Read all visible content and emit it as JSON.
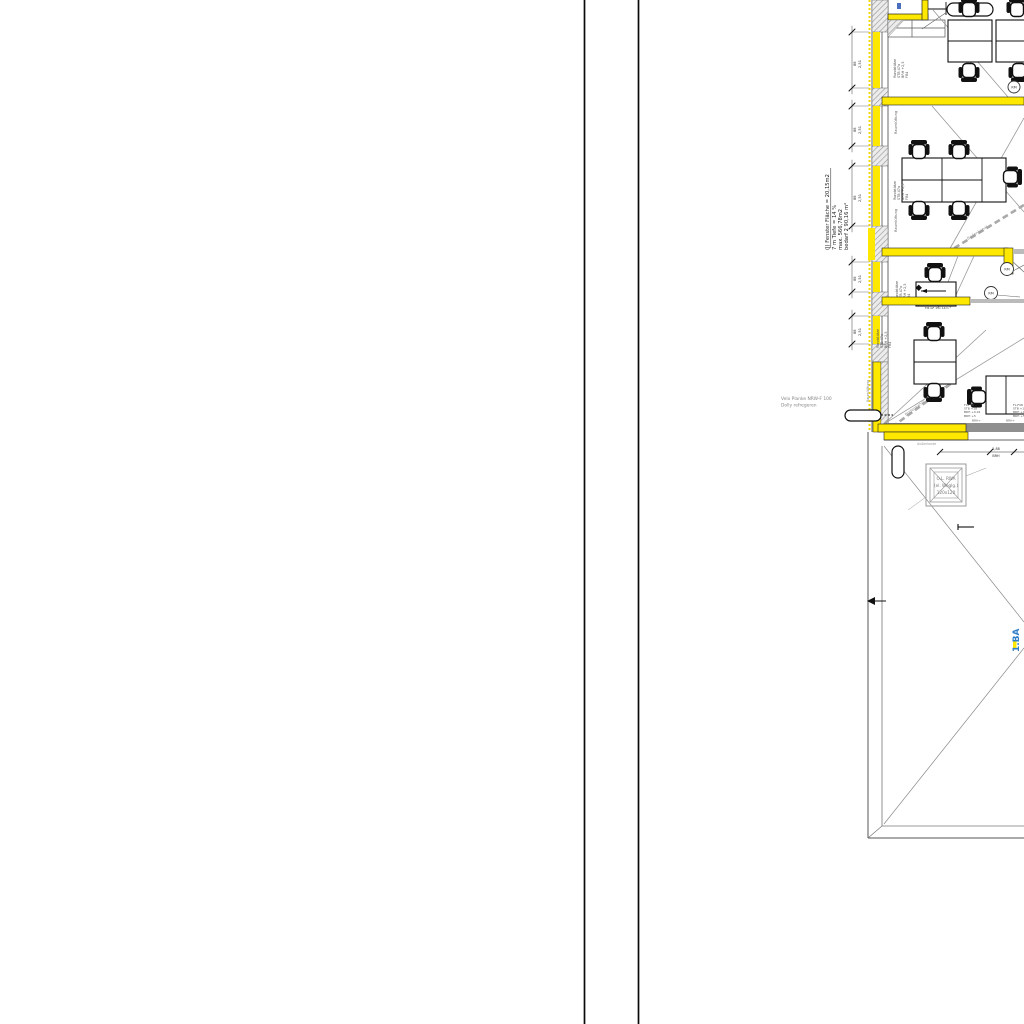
{
  "document": {
    "kind": "architectural-floor-plan-fragment",
    "background": "#ffffff"
  },
  "colors": {
    "divider_line": "#0a0a0a",
    "wall_yellow": "#ffe800",
    "wall_gray": "#8f8f8f",
    "hatch_gray": "#9a9a9a",
    "annotation_gray": "#555555",
    "accent_blue": "#2e7fc8"
  },
  "texts": {
    "fenster_note": {
      "l1": "(J) Fenster Fläche = 20,15m2",
      "l2": "7 m Tiefe = 14 %",
      "l3": "max. 566,78m2",
      "l4": "bedarf 2 90,16 m²"
    },
    "window_label": "Raumlüftung",
    "win_block": {
      "l1": "Rundstütze",
      "l2": "STB 47a",
      "l3": "BRH +2,5",
      "l4": "F84"
    },
    "desk_block": {
      "l1": "FL-F08",
      "l2": "STB +18",
      "l3": "BRH +0,91",
      "l4": "BRH +5"
    },
    "note_left": {
      "l1": "Velo Planke NRW-F 100",
      "l2": "Dolly refregeren"
    },
    "rwa": {
      "l1": "O.L. RWA",
      "l2": "(el. Weglg.)",
      "l3": "120x120"
    },
    "dim": {
      "a": "88",
      "b": "2,51"
    },
    "dim_hall": {
      "a": "5,88",
      "b": "BRH"
    },
    "rm": "RM",
    "fbgf": "F.B.GF 15x 14m",
    "aussenkante": "Außenkante",
    "brh": "BRH+",
    "bodenkanal": "Bodenkanal",
    "blue_label": "1.BA"
  }
}
